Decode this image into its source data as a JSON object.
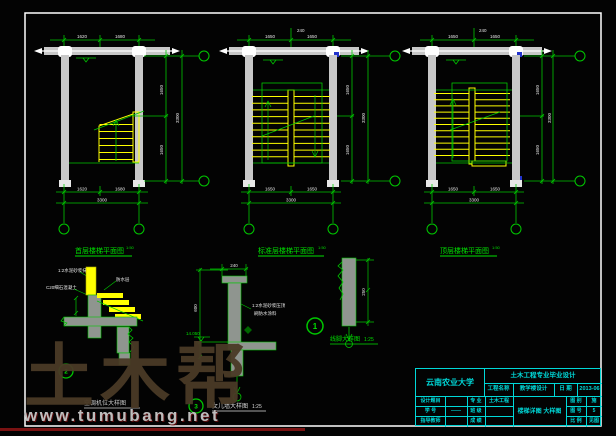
{
  "colors": {
    "line_green": "#00c800",
    "stair_yellow": "#ffff00",
    "titleblock_cyan": "#00d8d8",
    "column_gray": "#c8c8c8",
    "dim_text_white": "#e8e8e8",
    "marker_blue": "#2233cc",
    "watermark_brown": "#4a3a26",
    "watermark_red": "#7a1212"
  },
  "plans": [
    {
      "caption": "首层楼梯平面图",
      "scale": "1:50"
    },
    {
      "caption": "标准层楼梯平面图",
      "scale": "1:50"
    },
    {
      "caption": "顶层楼梯平面图",
      "scale": "1:50"
    }
  ],
  "dims": {
    "end": "240",
    "p1_a": "1620",
    "p1_b": "1680",
    "half": "1650",
    "total": "3300"
  },
  "details": [
    {
      "marker": "2",
      "caption": "空调机位大样图",
      "scale": "",
      "notes": [
        "1:2水泥砂浆抹面",
        "C20细石混凝土",
        "防水层"
      ]
    },
    {
      "marker": "3",
      "caption": "女儿墙大样图",
      "scale": "1:25",
      "notes": [
        "1:2水泥砂浆压顶",
        "刷防水涂料"
      ],
      "level": "14.050",
      "top_dim": "240",
      "side_dim": "600"
    },
    {
      "marker": "1",
      "caption": "线脚大样图",
      "scale": "1:25",
      "side_dim": "250"
    }
  ],
  "title_block": {
    "university": "云南农业大学",
    "project_type": "土木工程专业毕业设计",
    "drawing_title": "楼梯详图 大样图",
    "labels": {
      "project": "工程名称",
      "date": "日 期",
      "topic": "设计题目",
      "major": "专 业",
      "student_no": "学 号",
      "class": "班 级",
      "advisor": "指导教师",
      "grade": "成 绩",
      "sheet_type": "图 别",
      "sheet_no": "图 号",
      "ratio": "比 例"
    },
    "values": {
      "project": "教学楼设计",
      "date": "2013-06",
      "topic": "",
      "major": "土木工程",
      "student_no": "——",
      "class": "",
      "advisor": "",
      "grade": "",
      "sheet_type": "施",
      "sheet_no": "5",
      "ratio": "见图"
    }
  },
  "watermark": {
    "logo": "土木帮",
    "url": "www.tumubang.net"
  }
}
